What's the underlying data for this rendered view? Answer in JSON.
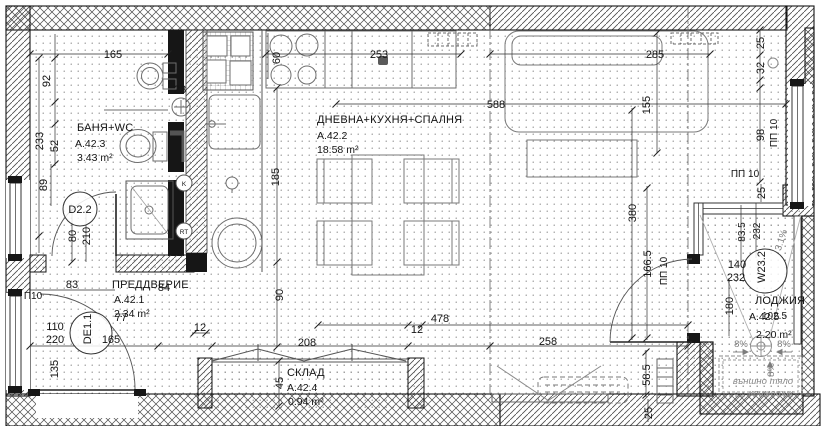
{
  "rooms": {
    "hall": {
      "name": "ПРЕДДВЕРИЕ",
      "code": "A.42.1",
      "area": "2.34 m²"
    },
    "living": {
      "name": "ДНЕВНА+КУХНЯ+СПАЛНЯ",
      "code": "A.42.2",
      "area": "18.58 m²"
    },
    "bath": {
      "name": "БАНЯ+WC",
      "code": "A.42.3",
      "area": "3.43 m²"
    },
    "storage": {
      "name": "СКЛАД",
      "code": "A.42.4",
      "area": "0.94 m²"
    },
    "loggia": {
      "name": "ЛОДЖИЯ",
      "code": "А.42.5",
      "area": "2.20 m²"
    }
  },
  "tags": {
    "bath_door": "D2.2",
    "entry_door": "DE1.1",
    "loggia_window": "W23.2",
    "k": "K",
    "rt": "RT"
  },
  "dims": {
    "d165a": "165",
    "d92": "92",
    "d23": "23",
    "d233": "233",
    "d52": "52",
    "d89": "89",
    "d80": "80",
    "d210": "210",
    "d110": "110",
    "d220": "220",
    "d135": "135",
    "d83": "83",
    "d84": "84",
    "d77": "77",
    "d165b": "165",
    "d12a": "12",
    "d90": "90",
    "d60": "60",
    "d253": "253",
    "d185": "185",
    "d588": "588",
    "d285": "285",
    "d155": "155",
    "d25a": "25",
    "d32": "32",
    "d98": "98",
    "d380": "380",
    "d1665": "166.5",
    "d478": "478",
    "d12b": "12",
    "d208": "208",
    "d258": "258",
    "d45": "45",
    "d585": "58.5",
    "d25b": "25",
    "d835": "83.5",
    "d232a": "232",
    "d140": "140",
    "d232b": "232",
    "d180": "180",
    "d1025": "102.5",
    "d25c": "25"
  },
  "annotations": {
    "pp10": "ПП 10",
    "p10": "П10",
    "slope8": "8%",
    "slope31": "3.1%",
    "ac1": "външно тяло",
    "ac2": "климатик"
  }
}
